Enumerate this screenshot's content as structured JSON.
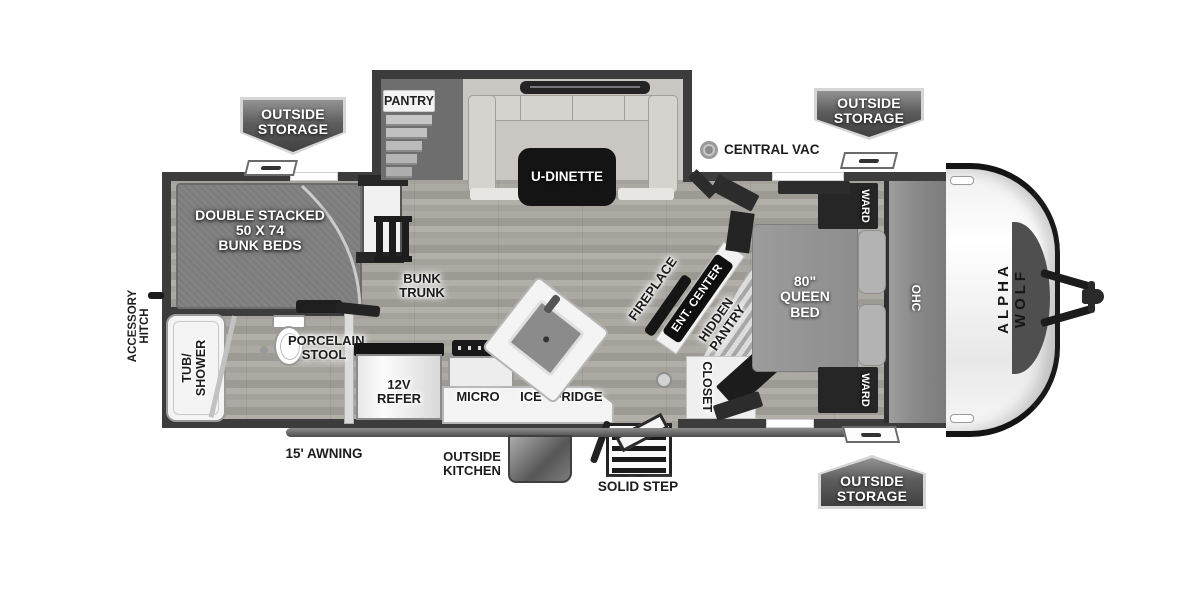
{
  "colors": {
    "wall": "#3c3c3c",
    "floor_light": "#b2aea8",
    "floor_dark": "#9d9993",
    "badge_gradient_top": "#939393",
    "badge_gradient_bottom": "#404040",
    "dark_fixture": "#141414",
    "front_cap_white": "#f5f5f5",
    "bunk_mat": "#7d7d7d"
  },
  "badges": {
    "top_left": {
      "line1": "OUTSIDE",
      "line2": "STORAGE"
    },
    "top_right": {
      "line1": "OUTSIDE",
      "line2": "STORAGE"
    },
    "bottom_right": {
      "line1": "OUTSIDE",
      "line2": "STORAGE"
    }
  },
  "exterior": {
    "brand": "ALPHA WOLF",
    "central_vac": "CENTRAL VAC",
    "accessory_hitch": {
      "line1": "ACCESSORY",
      "line2": "HITCH"
    },
    "awning": "15' AWNING",
    "outside_kitchen": {
      "line1": "OUTSIDE",
      "line2": "KITCHEN"
    },
    "solid_step": "SOLID STEP"
  },
  "slideout": {
    "pantry": "PANTRY",
    "dinette": "U-DINETTE"
  },
  "bunk_room": {
    "bunks": {
      "line1": "DOUBLE STACKED",
      "line2": "50 X 74",
      "line3": "BUNK BEDS"
    },
    "trunk": {
      "line1": "BUNK",
      "line2": "TRUNK"
    }
  },
  "bathroom": {
    "tub": {
      "line1": "TUB/",
      "line2": "SHOWER"
    },
    "toilet": {
      "line1": "PORCELAIN",
      "line2": "STOOL"
    }
  },
  "kitchen": {
    "refer": {
      "line1": "12V",
      "line2": "REFER"
    },
    "micro": "MICRO",
    "ice": "ICE",
    "fridge": "FRIDGE"
  },
  "living": {
    "fireplace": "FIREPLACE",
    "ent_center": "ENT. CENTER",
    "hidden_pantry": {
      "line1": "HIDDEN",
      "line2": "PANTRY"
    },
    "closet": "CLOSET"
  },
  "bedroom": {
    "bed": {
      "line1": "80\"",
      "line2": "QUEEN",
      "line3": "BED"
    },
    "ward_top": "WARD",
    "ward_bottom": "WARD",
    "ohc": "OHC"
  }
}
